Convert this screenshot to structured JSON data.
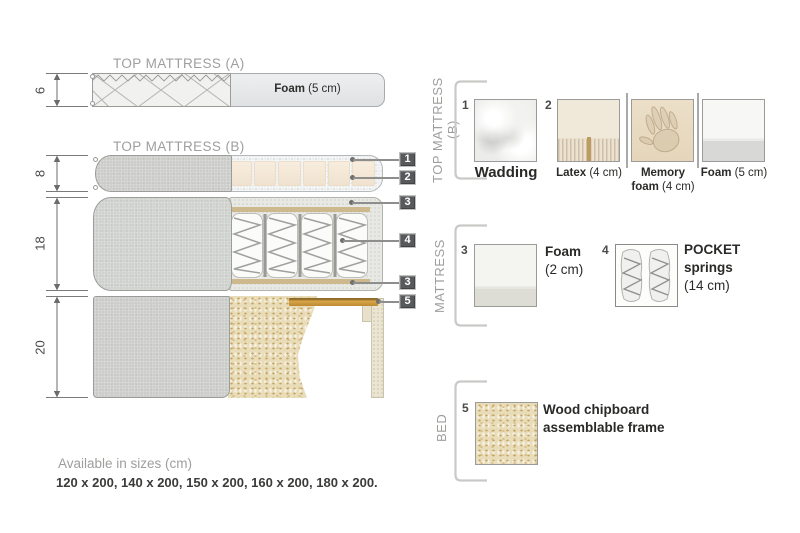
{
  "diagram": {
    "top_a": {
      "title": "TOP MATTRESS (A)",
      "dim": "6",
      "foam_label": "Foam",
      "foam_size": "(5 cm)"
    },
    "top_b": {
      "title": "TOP MATTRESS (B)",
      "dim": "8"
    },
    "mattress": {
      "dim": "18"
    },
    "bed": {
      "dim": "20"
    },
    "callouts": [
      "1",
      "2",
      "3",
      "4",
      "3",
      "5"
    ]
  },
  "legend": {
    "top_b": {
      "label": "TOP MATTRESS (B)",
      "item1": {
        "num": "1",
        "name": "Wadding"
      },
      "item2": {
        "num": "2",
        "name": "Latex",
        "size": "(4 cm)"
      },
      "item3": {
        "name_line1": "Memory",
        "name_line2": "foam",
        "size": "(4 cm)"
      },
      "item4": {
        "name": "Foam",
        "size": "(5 cm)"
      }
    },
    "mattress": {
      "label": "MATTRESS",
      "item3": {
        "num": "3",
        "name": "Foam",
        "size": "(2 cm)"
      },
      "item4": {
        "num": "4",
        "name_line1": "POCKET",
        "name_line2": "springs",
        "size": "(14 cm)"
      }
    },
    "bed": {
      "label": "BED",
      "item5": {
        "num": "5",
        "name_line1": "Wood chipboard",
        "name_line2": "assemblable frame"
      }
    }
  },
  "footer": {
    "title": "Available in sizes (cm)",
    "sizes": "120 x 200, 140 x 200, 150 x 200, 160 x 200, 180 x 200."
  },
  "colors": {
    "label_box": "#58595b",
    "gray_text": "#9e9e9c",
    "dark_text": "#2a2a28",
    "fabric_gray": "#c9cbc7",
    "latex_cream": "#f5e9d9",
    "wood_slat": "#c9963c",
    "chipboard": "#e8dcb9",
    "spring_strip": "#cdb98d"
  }
}
